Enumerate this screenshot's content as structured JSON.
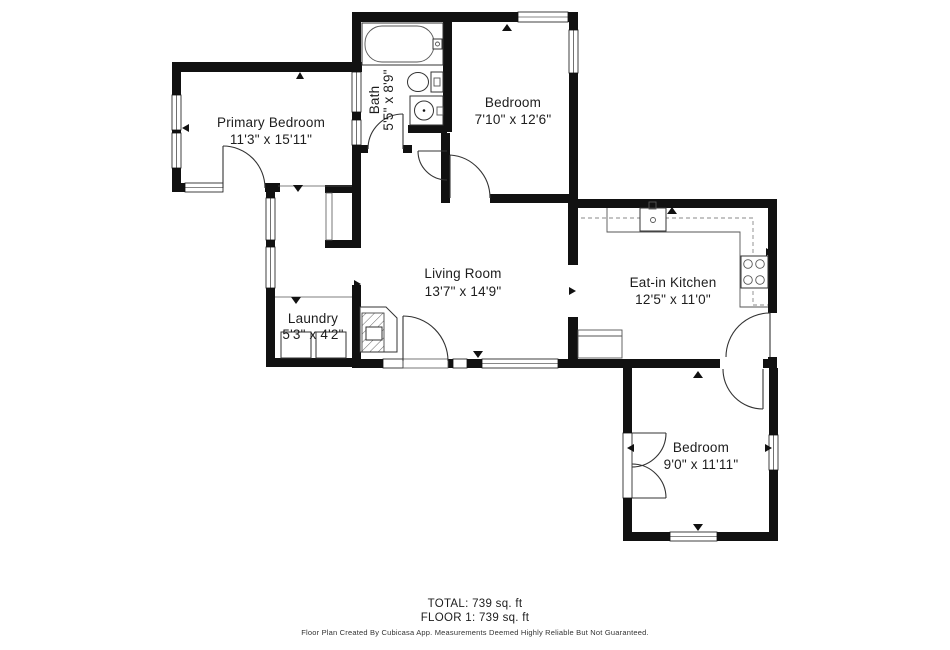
{
  "rooms": [
    {
      "id": "primary-bedroom",
      "name": "Primary Bedroom",
      "dims": "11'3\" x 15'11\""
    },
    {
      "id": "bath",
      "name": "Bath",
      "dims": "5'5\" x 8'9\""
    },
    {
      "id": "bedroom-top",
      "name": "Bedroom",
      "dims": "7'10\" x 12'6\""
    },
    {
      "id": "living-room",
      "name": "Living Room",
      "dims": "13'7\" x 14'9\""
    },
    {
      "id": "eat-in-kitchen",
      "name": "Eat-in Kitchen",
      "dims": "12'5\" x 11'0\""
    },
    {
      "id": "laundry",
      "name": "Laundry",
      "dims": "5'3\" x 4'2\""
    },
    {
      "id": "bedroom-bottom",
      "name": "Bedroom",
      "dims": "9'0\" x 11'11\""
    }
  ],
  "summary": {
    "total": "TOTAL: 739 sq. ft",
    "floor1": "FLOOR 1: 739 sq. ft"
  },
  "disclaimer": "Floor Plan Created By Cubicasa App. Measurements Deemed Highly Reliable But Not Guaranteed.",
  "colors": {
    "wall": "#111111",
    "text": "#1d1d1d",
    "fixture": "#333333"
  }
}
